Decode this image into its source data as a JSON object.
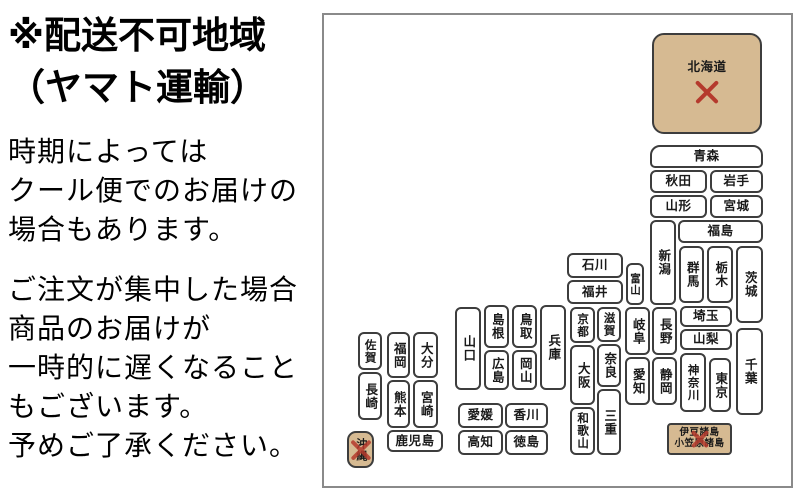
{
  "left_panel": {
    "title_line1": "※配送不可地域",
    "title_line2": "（ヤマト運輸）",
    "paragraph1": [
      "時期によっては",
      "クール便でのお届けの",
      "場合もあります。"
    ],
    "paragraph2": [
      "ご注文が集中した場合",
      "商品のお届けが",
      "一時的に遅くなること",
      "もございます。",
      "予めご了承ください。"
    ]
  },
  "map": {
    "colors": {
      "restricted_fill": "#d6ba92",
      "x_mark": "#b53a2d",
      "box_border": "#3d3d3d",
      "map_border": "#8a8a8a"
    },
    "prefectures": [
      {
        "id": "hokkaido",
        "label": "北海道",
        "x": 328,
        "y": 18,
        "w": 110,
        "h": 101,
        "orient": "h",
        "restricted": true,
        "x_below": true,
        "x_size": 30,
        "radius": "12px"
      },
      {
        "id": "aomori",
        "label": "青森",
        "x": 326,
        "y": 130,
        "w": 113,
        "h": 23,
        "orient": "h",
        "radius": "10px 10px 5px 5px"
      },
      {
        "id": "akita",
        "label": "秋田",
        "x": 326,
        "y": 155,
        "w": 57,
        "h": 23,
        "orient": "h"
      },
      {
        "id": "iwate",
        "label": "岩手",
        "x": 386,
        "y": 155,
        "w": 53,
        "h": 23,
        "orient": "h"
      },
      {
        "id": "yamagata",
        "label": "山形",
        "x": 326,
        "y": 180,
        "w": 57,
        "h": 23,
        "orient": "h"
      },
      {
        "id": "miyagi",
        "label": "宮城",
        "x": 386,
        "y": 180,
        "w": 53,
        "h": 23,
        "orient": "h"
      },
      {
        "id": "fukushima",
        "label": "福島",
        "x": 354,
        "y": 205,
        "w": 85,
        "h": 23,
        "orient": "h"
      },
      {
        "id": "niigata",
        "label": "新潟",
        "x": 326,
        "y": 205,
        "w": 26,
        "h": 85,
        "orient": "v"
      },
      {
        "id": "gunma",
        "label": "群馬",
        "x": 355,
        "y": 231,
        "w": 25,
        "h": 57,
        "orient": "v"
      },
      {
        "id": "tochigi",
        "label": "栃木",
        "x": 383,
        "y": 231,
        "w": 26,
        "h": 57,
        "orient": "v"
      },
      {
        "id": "ibaraki",
        "label": "茨城",
        "x": 412,
        "y": 231,
        "w": 27,
        "h": 77,
        "orient": "v"
      },
      {
        "id": "ishikawa",
        "label": "石川",
        "x": 243,
        "y": 238,
        "w": 56,
        "h": 25,
        "orient": "h"
      },
      {
        "id": "fukui",
        "label": "福井",
        "x": 243,
        "y": 265,
        "w": 56,
        "h": 24,
        "orient": "h"
      },
      {
        "id": "toyama",
        "label": "富山",
        "x": 302,
        "y": 248,
        "w": 18,
        "h": 42,
        "orient": "v",
        "fontSize": 10.5
      },
      {
        "id": "nagano",
        "label": "長野",
        "x": 328,
        "y": 292,
        "w": 25,
        "h": 48,
        "orient": "v"
      },
      {
        "id": "shizuoka",
        "label": "静岡",
        "x": 328,
        "y": 342,
        "w": 25,
        "h": 48,
        "orient": "v"
      },
      {
        "id": "gifu",
        "label": "岐阜",
        "x": 301,
        "y": 292,
        "w": 25,
        "h": 48,
        "orient": "v"
      },
      {
        "id": "aichi",
        "label": "愛知",
        "x": 301,
        "y": 342,
        "w": 25,
        "h": 48,
        "orient": "v"
      },
      {
        "id": "shiga",
        "label": "滋賀",
        "x": 273,
        "y": 292,
        "w": 24,
        "h": 35,
        "orient": "v",
        "fontSize": 11.5
      },
      {
        "id": "nara",
        "label": "奈良",
        "x": 273,
        "y": 329,
        "w": 24,
        "h": 43,
        "orient": "v"
      },
      {
        "id": "mie",
        "label": "三重",
        "x": 273,
        "y": 374,
        "w": 24,
        "h": 66,
        "orient": "v"
      },
      {
        "id": "kyoto",
        "label": "京都",
        "x": 246,
        "y": 292,
        "w": 25,
        "h": 36,
        "orient": "v",
        "fontSize": 11.5
      },
      {
        "id": "osaka",
        "label": "大阪",
        "x": 246,
        "y": 330,
        "w": 25,
        "h": 60,
        "orient": "v"
      },
      {
        "id": "wakayama",
        "label": "和歌山",
        "x": 246,
        "y": 392,
        "w": 25,
        "h": 48,
        "orient": "v",
        "fontSize": 11.5
      },
      {
        "id": "hyogo",
        "label": "兵庫",
        "x": 216,
        "y": 290,
        "w": 26,
        "h": 85,
        "orient": "v"
      },
      {
        "id": "tottori",
        "label": "鳥取",
        "x": 188,
        "y": 290,
        "w": 25,
        "h": 43,
        "orient": "v"
      },
      {
        "id": "okayama",
        "label": "岡山",
        "x": 188,
        "y": 335,
        "w": 25,
        "h": 40,
        "orient": "v"
      },
      {
        "id": "shimane",
        "label": "島根",
        "x": 160,
        "y": 290,
        "w": 25,
        "h": 43,
        "orient": "v"
      },
      {
        "id": "hiroshima",
        "label": "広島",
        "x": 160,
        "y": 335,
        "w": 25,
        "h": 40,
        "orient": "v"
      },
      {
        "id": "yamaguchi",
        "label": "山口",
        "x": 131,
        "y": 292,
        "w": 26,
        "h": 83,
        "orient": "v"
      },
      {
        "id": "saitama",
        "label": "埼玉",
        "x": 356,
        "y": 291,
        "w": 52,
        "h": 21,
        "orient": "h"
      },
      {
        "id": "yamanashi",
        "label": "山梨",
        "x": 356,
        "y": 314,
        "w": 52,
        "h": 21,
        "orient": "h"
      },
      {
        "id": "kanagawa",
        "label": "神奈川",
        "x": 356,
        "y": 338,
        "w": 26,
        "h": 59,
        "orient": "v",
        "fontSize": 11.5
      },
      {
        "id": "tokyo",
        "label": "東京",
        "x": 385,
        "y": 343,
        "w": 22,
        "h": 54,
        "orient": "v"
      },
      {
        "id": "chiba",
        "label": "千葉",
        "x": 412,
        "y": 313,
        "w": 27,
        "h": 87,
        "orient": "v"
      },
      {
        "id": "ehime",
        "label": "愛媛",
        "x": 134,
        "y": 388,
        "w": 45,
        "h": 25,
        "orient": "h"
      },
      {
        "id": "kagawa",
        "label": "香川",
        "x": 181,
        "y": 388,
        "w": 43,
        "h": 25,
        "orient": "h"
      },
      {
        "id": "kochi",
        "label": "高知",
        "x": 134,
        "y": 415,
        "w": 45,
        "h": 25,
        "orient": "h"
      },
      {
        "id": "tokushima",
        "label": "徳島",
        "x": 181,
        "y": 415,
        "w": 43,
        "h": 25,
        "orient": "h"
      },
      {
        "id": "saga",
        "label": "佐賀",
        "x": 34,
        "y": 317,
        "w": 24,
        "h": 38,
        "orient": "v",
        "fontSize": 11.5
      },
      {
        "id": "nagasaki",
        "label": "長崎",
        "x": 34,
        "y": 357,
        "w": 24,
        "h": 48,
        "orient": "v"
      },
      {
        "id": "fukuoka",
        "label": "福岡",
        "x": 63,
        "y": 317,
        "w": 23,
        "h": 46,
        "orient": "v"
      },
      {
        "id": "kumamoto",
        "label": "熊本",
        "x": 63,
        "y": 365,
        "w": 23,
        "h": 48,
        "orient": "v"
      },
      {
        "id": "oita",
        "label": "大分",
        "x": 89,
        "y": 317,
        "w": 25,
        "h": 46,
        "orient": "v"
      },
      {
        "id": "miyazaki",
        "label": "宮崎",
        "x": 89,
        "y": 365,
        "w": 25,
        "h": 48,
        "orient": "v"
      },
      {
        "id": "kagoshima",
        "label": "鹿児島",
        "x": 63,
        "y": 415,
        "w": 56,
        "h": 22,
        "orient": "h"
      },
      {
        "id": "okinawa",
        "label": "沖縄",
        "x": 23,
        "y": 416,
        "w": 27,
        "h": 37,
        "orient": "v",
        "restricted": true,
        "x_size": 26,
        "radius": "9px",
        "fontSize": 11
      },
      {
        "id": "izu-ogasawara",
        "lines": [
          "伊豆諸島",
          "小笠原諸島"
        ],
        "x": 343,
        "y": 408,
        "w": 65,
        "h": 32,
        "orient": "h",
        "restricted": true,
        "x_size": 22,
        "radius": "4px",
        "fontSize": 9.5
      }
    ]
  }
}
